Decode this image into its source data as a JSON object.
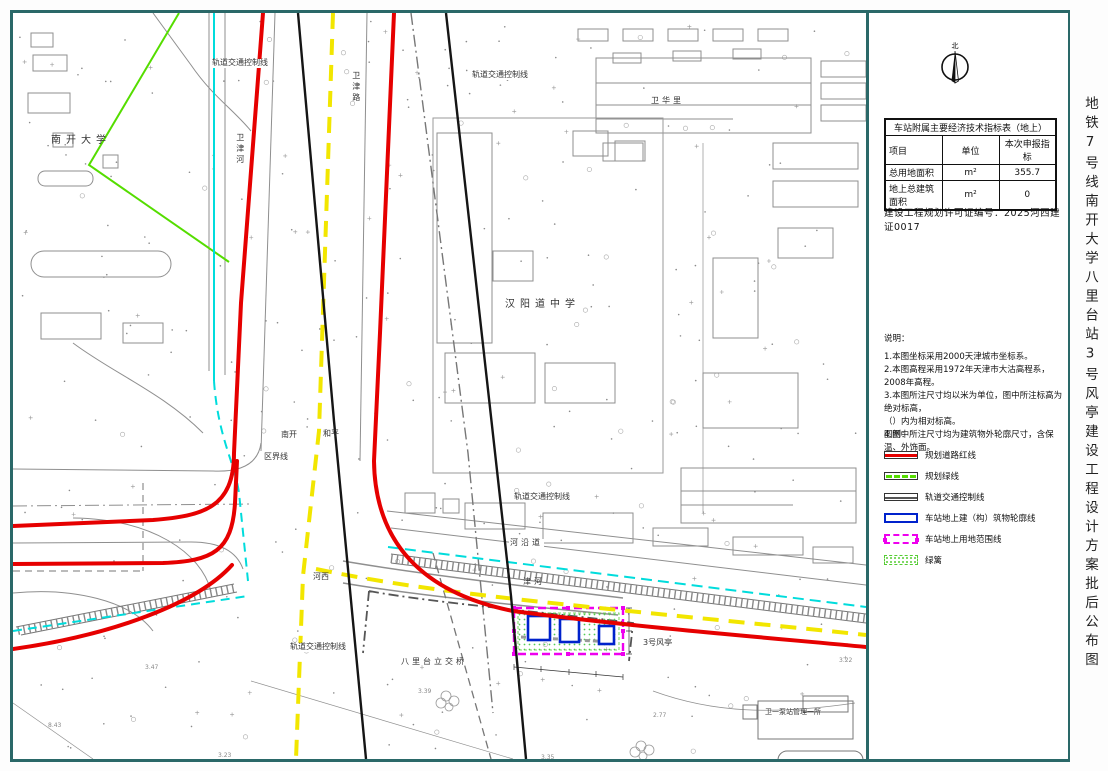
{
  "title_vertical": "地铁7号线南开大学八里台站3号风亭建设工程设计方案批后公布图",
  "compass": {
    "north_label": "北"
  },
  "table": {
    "title": "车站附属主要经济技术指标表（地上）",
    "headers": [
      "项目",
      "单位",
      "本次申报指标"
    ],
    "rows": [
      [
        "总用地面积",
        "m²",
        "355.7"
      ],
      [
        "地上总建筑面积",
        "m²",
        "0"
      ]
    ]
  },
  "permit": "建设工程规划许可证编号：2025河西建证0017",
  "notes": {
    "title": "说明：",
    "lines": [
      "1.本图坐标采用2000天津城市坐标系。",
      "2.本图高程采用1972年天津市大沽高程系，2008年高程。",
      "3.本图所注尺寸均以米为单位，图中所注标高为绝对标高，",
      "（）内为相对标高。",
      "4.图中所注尺寸均为建筑物外轮廓尺寸，含保温、外饰面。"
    ]
  },
  "legend": {
    "title": "图例：",
    "items": [
      {
        "type": "road-red-line",
        "label": "规划道路红线"
      },
      {
        "type": "green-line",
        "label": "规划绿线"
      },
      {
        "type": "rail-control-line",
        "label": "轨道交通控制线"
      },
      {
        "type": "station-outline",
        "label": "车站地上建（构）筑物轮廓线"
      },
      {
        "type": "site-boundary",
        "label": "车站地上用地范围线"
      },
      {
        "type": "hedge",
        "label": "绿篱"
      }
    ]
  },
  "map": {
    "labels": [
      {
        "text": "南开大学",
        "x": 38,
        "y": 122,
        "cls": "sp"
      },
      {
        "text": "卫津河",
        "x": 222,
        "y": 120,
        "cls": "vertical small"
      },
      {
        "text": "轨道交通控制线",
        "x": 198,
        "y": 46,
        "cls": "small wbg"
      },
      {
        "text": "卫津路",
        "x": 338,
        "y": 58,
        "cls": "vertical small"
      },
      {
        "text": "轨道交通控制线",
        "x": 458,
        "y": 58,
        "cls": "small wbg"
      },
      {
        "text": "卫华里",
        "x": 638,
        "y": 84,
        "cls": "small sp2"
      },
      {
        "text": "汉阳道中学",
        "x": 492,
        "y": 286,
        "cls": "sp"
      },
      {
        "text": "南开",
        "x": 268,
        "y": 418,
        "cls": "small"
      },
      {
        "text": "和平",
        "x": 310,
        "y": 417,
        "cls": "small"
      },
      {
        "text": "区界线",
        "x": 250,
        "y": 440,
        "cls": "small wbg"
      },
      {
        "text": "轨道交通控制线",
        "x": 500,
        "y": 480,
        "cls": "small wbg"
      },
      {
        "text": "河沿道",
        "x": 496,
        "y": 526,
        "cls": "small sp2 wbg"
      },
      {
        "text": "津河",
        "x": 510,
        "y": 565,
        "cls": "small sp2"
      },
      {
        "text": "河西",
        "x": 300,
        "y": 560,
        "cls": "small"
      },
      {
        "text": "轨道交通控制线",
        "x": 276,
        "y": 630,
        "cls": "small wbg"
      },
      {
        "text": "八里台立交桥",
        "x": 388,
        "y": 645,
        "cls": "small sp2"
      },
      {
        "text": "3号风亭",
        "x": 630,
        "y": 626,
        "cls": "small"
      },
      {
        "text": "卫一泵站管理一所",
        "x": 752,
        "y": 696,
        "cls": "tiny"
      }
    ],
    "spots": [
      {
        "text": "3.47",
        "x": 132,
        "y": 652,
        "cls": "spot"
      },
      {
        "text": "8.43",
        "x": 35,
        "y": 710,
        "cls": "spot"
      },
      {
        "text": "3.23",
        "x": 205,
        "y": 740,
        "cls": "spot"
      },
      {
        "text": "3.39",
        "x": 405,
        "y": 676,
        "cls": "spot"
      },
      {
        "text": "2.77",
        "x": 640,
        "y": 700,
        "cls": "spot"
      },
      {
        "text": "3.22",
        "x": 826,
        "y": 645,
        "cls": "spot"
      },
      {
        "text": "3.35",
        "x": 528,
        "y": 742,
        "cls": "spot"
      }
    ],
    "colors": {
      "road_red": "#e60000",
      "district_yellow": "#f2e600",
      "river_cyan": "#00dcdc",
      "green_line": "#55dd00",
      "station_blue": "#0022cc",
      "site_magenta": "#ee00ee",
      "border_teal": "#2a6868"
    }
  }
}
